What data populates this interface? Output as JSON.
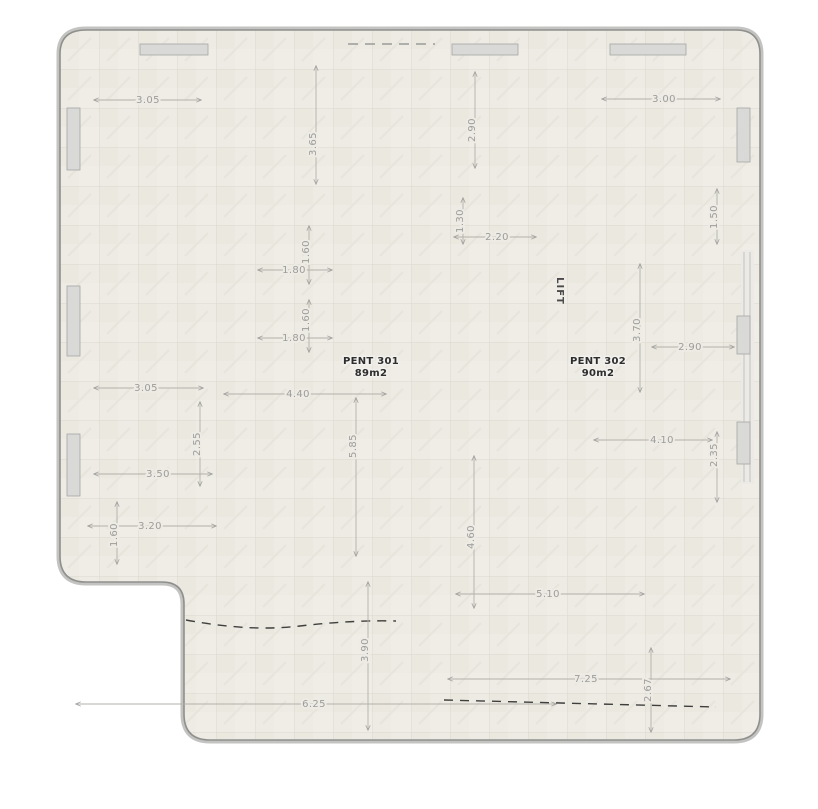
{
  "units": [
    {
      "name": "PENT 301",
      "area": "89m2"
    },
    {
      "name": "PENT 302",
      "area": "90m2"
    }
  ],
  "core": {
    "lift_label": "LIFT"
  },
  "dims": {
    "d1": "3.05",
    "d2": "3.65",
    "d3": "2.90",
    "d4": "3.00",
    "d5": "3.05",
    "d6": "1.80",
    "d7": "1.60",
    "d8": "1.80",
    "d9": "1.60",
    "d10": "1.30",
    "d11": "2.20",
    "d12": "1.50",
    "d13": "3.70",
    "d14": "2.90",
    "d15": "4.10",
    "d16": "2.35",
    "d17": "4.40",
    "d18": "2.55",
    "d19": "5.85",
    "d20": "3.50",
    "d21": "3.20",
    "d22": "1.60",
    "d23": "4.60",
    "d24": "5.10",
    "d25": "6.25",
    "d26": "3.90",
    "d27": "7.25",
    "d28": "2.67"
  },
  "colors": {
    "wall": "#161616",
    "wood_floor": "#c68b4e",
    "terrace_tile": "#edebe4",
    "bathroom_tile": "#3d413e",
    "corridor_tile": "#f5f4f0",
    "furniture": "#d4d4d2",
    "dimension_text": "#9c9c9a",
    "boundary": "#b9b9b7"
  }
}
